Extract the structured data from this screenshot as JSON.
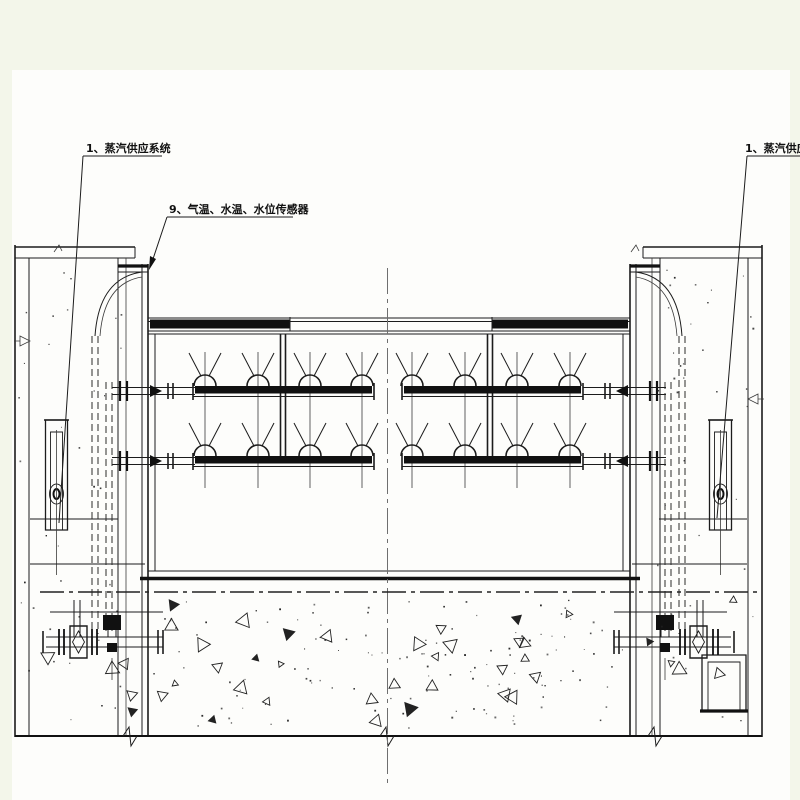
{
  "drawing": {
    "callouts": {
      "steam_supply_left": "1、蒸汽供应系统",
      "sensors": "9、气温、水温、水位传感器",
      "steam_supply_right": "1、蒸汽供应系统"
    },
    "colors": {
      "margin": "#f3f6ea",
      "paper": "#fdfdfb",
      "line": "#1c1c1c",
      "centerline": "#6f6f6f"
    }
  }
}
